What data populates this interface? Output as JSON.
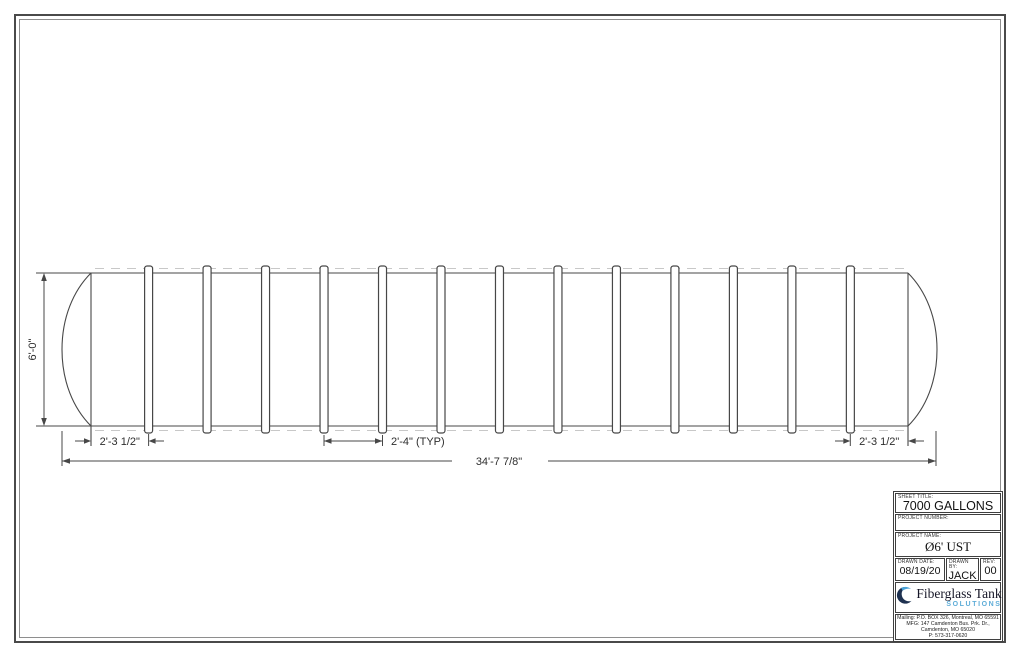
{
  "page": {
    "background": "#ffffff",
    "border_color": "#4a4a4a"
  },
  "drawing": {
    "type": "technical-drawing",
    "subject": "horizontal cylindrical fiberglass tank, side elevation, ribbed",
    "line_color": "#474747",
    "dashed_line_color": "#c8c8c8",
    "rib_count": 13,
    "dimensions": {
      "diameter": "6'-0\"",
      "end_spacing_left": "2'-3 1/2\"",
      "rib_spacing": "2'-4\" (TYP)",
      "end_spacing_right": "2'-3 1/2\"",
      "overall_length": "34'-7 7/8\""
    }
  },
  "title_block": {
    "sheet_title_label": "SHEET TITLE:",
    "sheet_title": "7000 GALLONS",
    "project_number_label": "PROJECT NUMBER:",
    "project_number": "",
    "project_name_label": "PROJECT NAME:",
    "project_name": "Ø6' UST",
    "drawn_date_label": "DRAWN DATE:",
    "drawn_date": "08/19/20",
    "drawn_by_label": "DRAWN BY:",
    "drawn_by": "JACK",
    "rev_label": "REV:",
    "rev": "00",
    "logo": {
      "name": "Fiberglass Tank",
      "tagline": "SOLUTIONS",
      "navy": "#1e3150",
      "blue": "#4aa3d8"
    },
    "address_lines": [
      "Mailing: P.O. BOX 326, Montreal, MO 65591",
      "MFG: 147 Camdenton Bus. Prk. Dr.,",
      "Camdenton, MO 65020",
      "P: 573-317-0620"
    ]
  }
}
